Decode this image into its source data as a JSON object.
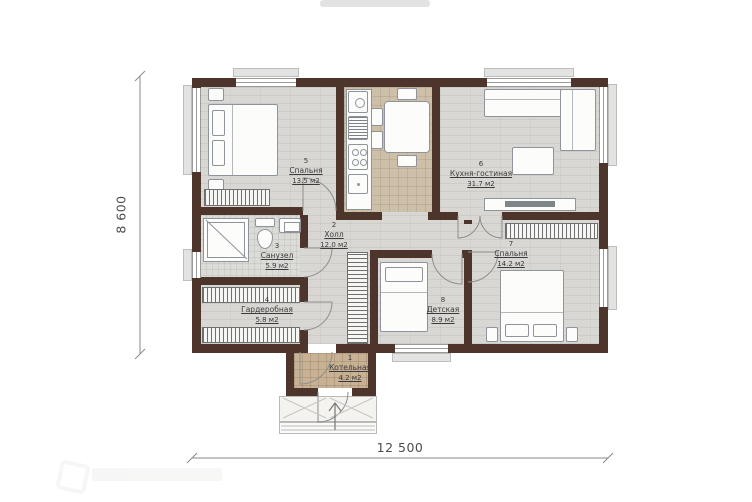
{
  "dimensions": {
    "height_label": "8 600",
    "width_label": "12 500"
  },
  "rooms": [
    {
      "num": "1",
      "name": "Котельная",
      "area": "4.2 м2"
    },
    {
      "num": "2",
      "name": "Холл",
      "area": "12.0 м2"
    },
    {
      "num": "3",
      "name": "Санузел",
      "area": "5.9 м2"
    },
    {
      "num": "4",
      "name": "Гардеробная",
      "area": "5.8 м2"
    },
    {
      "num": "5",
      "name": "Спальня",
      "area": "13.5 м2"
    },
    {
      "num": "6",
      "name": "Кухня-гостиная",
      "area": "31.7 м2"
    },
    {
      "num": "7",
      "name": "Спальня",
      "area": "14.2 м2"
    },
    {
      "num": "8",
      "name": "Детская",
      "area": "8.9 м2"
    }
  ],
  "colors": {
    "wall": "#4d352c",
    "wood_floor": "#d8d7d3",
    "kitchen_tile": "#cec0a8",
    "entry_tile": "#c9b193",
    "bath_tile": "#dbdbd8",
    "label_text": "#3b3b3b"
  }
}
